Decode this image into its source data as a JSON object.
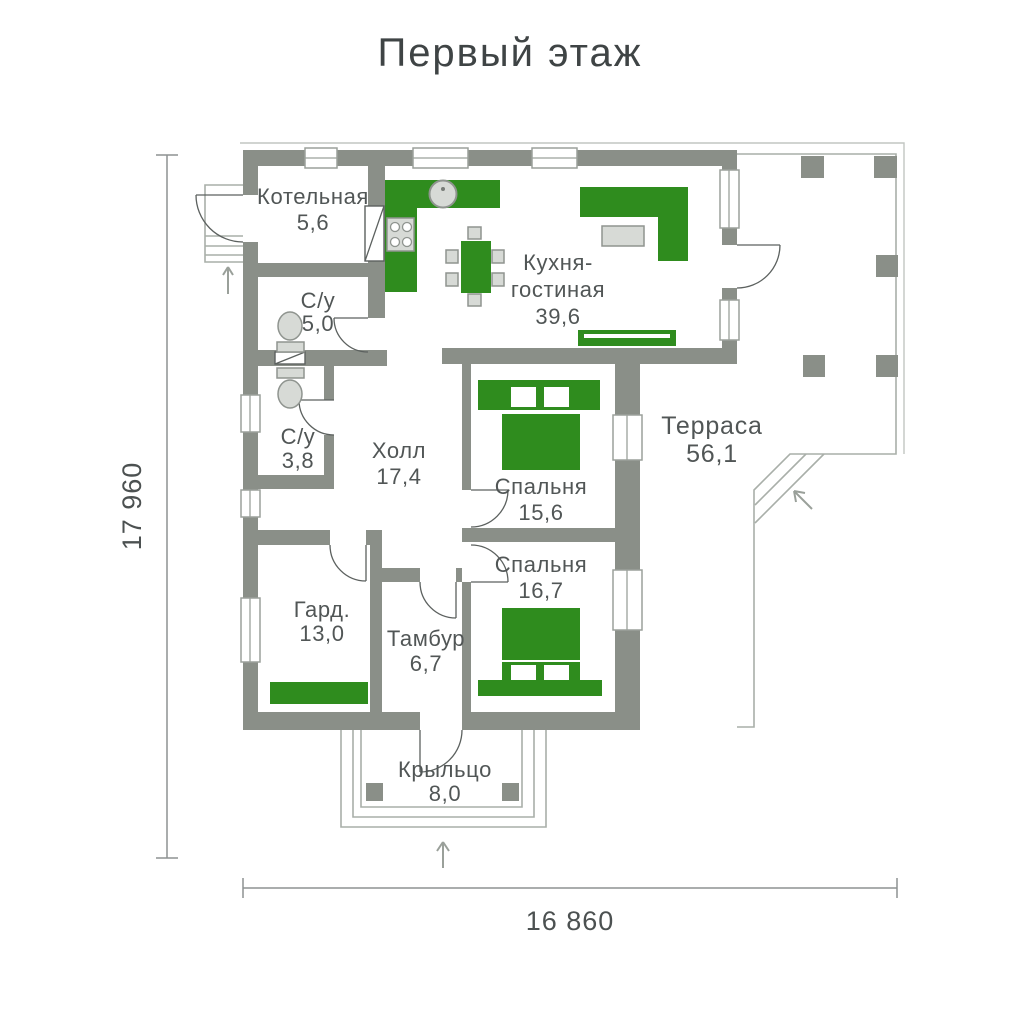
{
  "title": "Первый этаж",
  "colors": {
    "wall_gray": "#8a8f88",
    "furniture_green": "#2f8c1e",
    "fixture_light_gray": "#d7dad6",
    "label_text": "#515656"
  },
  "dimensions": {
    "vertical": "17 960",
    "horizontal": "16 860"
  },
  "rooms": {
    "boiler": {
      "name": "Котельная",
      "area": "5,6"
    },
    "bath1": {
      "name": "С/у",
      "area": "5,0"
    },
    "kitchen": {
      "name_line1": "Кухня-",
      "name_line2": "гостиная",
      "area": "39,6"
    },
    "bath2": {
      "name": "С/у",
      "area": "3,8"
    },
    "hall": {
      "name": "Холл",
      "area": "17,4"
    },
    "bedroom1": {
      "name": "Спальня",
      "area": "15,6"
    },
    "terrace": {
      "name": "Терраса",
      "area": "56,1"
    },
    "bedroom2": {
      "name": "Спальня",
      "area": "16,7"
    },
    "wardrobe": {
      "name": "Гард.",
      "area": "13,0"
    },
    "vestibule": {
      "name": "Тамбур",
      "area": "6,7"
    },
    "porch": {
      "name": "Крыльцо",
      "area": "8,0"
    }
  }
}
